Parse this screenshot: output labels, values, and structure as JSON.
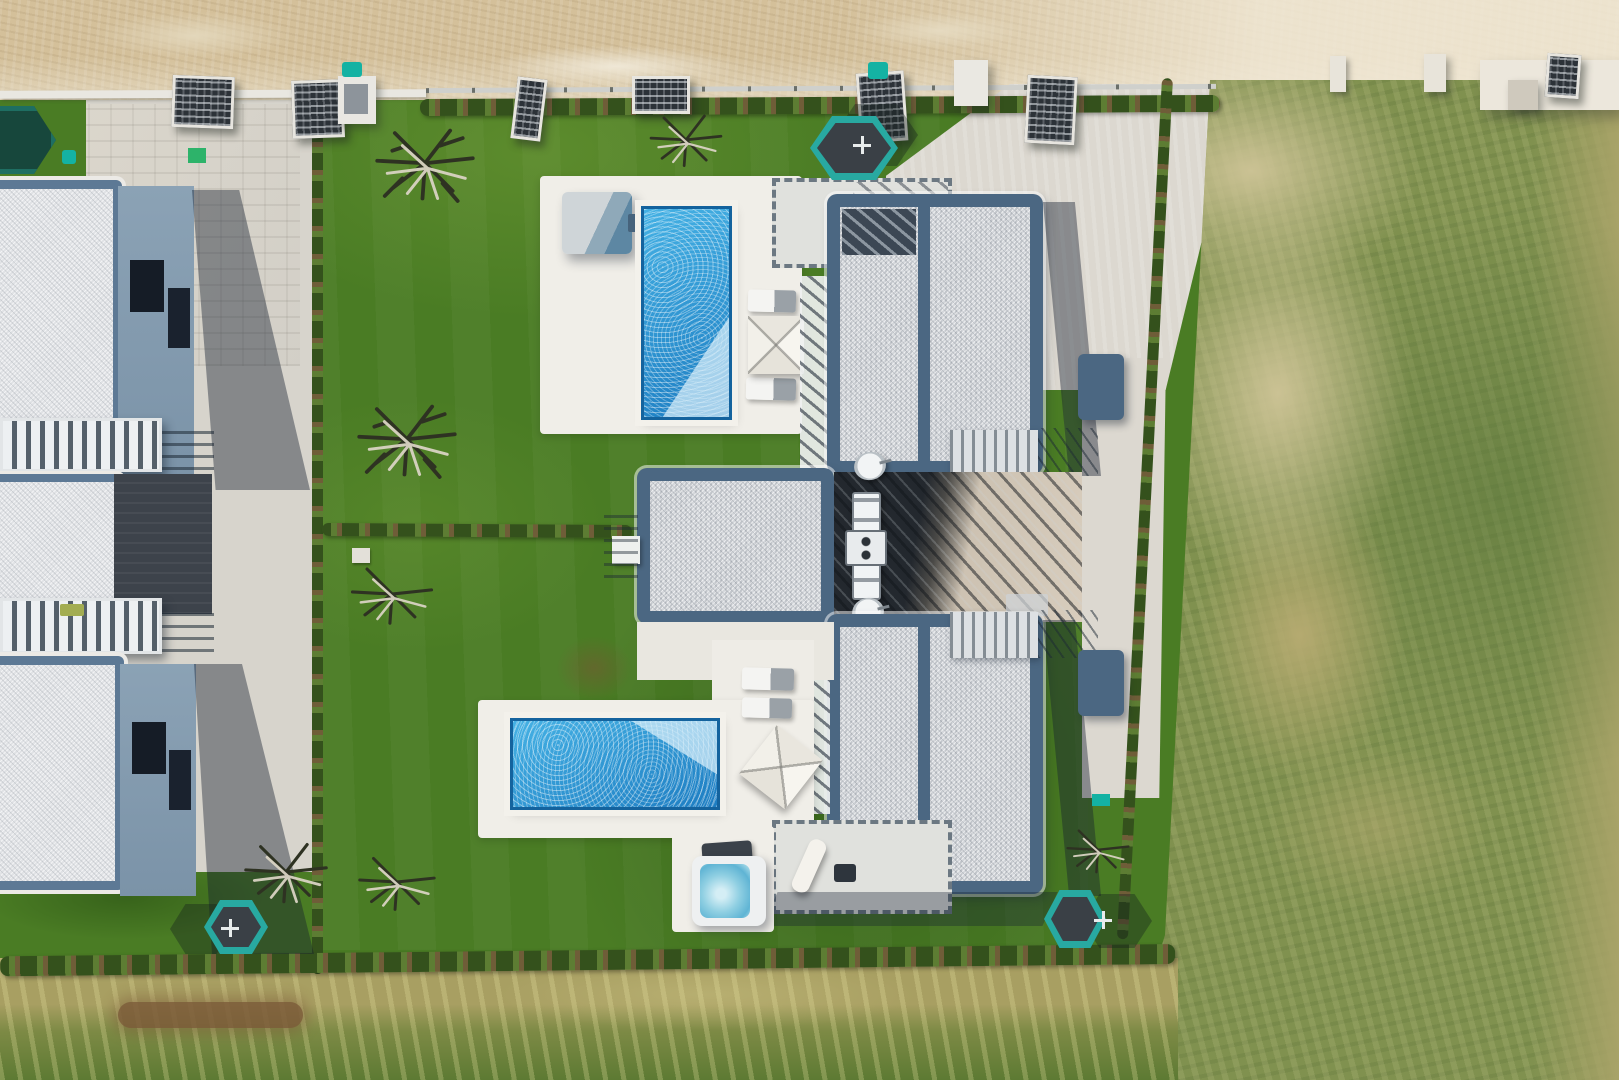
{
  "meta": {
    "title": "Aerial drone photograph, top-down view of a modern villa resort with private pools",
    "type": "aerial-photograph",
    "width_px": 1619,
    "height_px": 1080,
    "lighting": "bright midday sun, hard shadows cast toward the south-east"
  },
  "scene": {
    "setting": "Top-down drone view of a row of newly built modern holiday villas with white-gravel flat roofs framed in steel blue, bright green lawns, two rectangular swimming pools, a sandy dirt road along the top and a large patchy wild meadow on the right",
    "objects": [
      {
        "name": "dirt-road",
        "label": "Sandy gravel road running along the top edge"
      },
      {
        "name": "roadside-curb",
        "label": "Low white kerb wall between road and plots"
      },
      {
        "name": "roadside-hedge",
        "label": "Row of young hedge shrubs with wire fence along the road"
      },
      {
        "name": "entrance-gate",
        "label": "Dark slatted entrance gates and bin enclosures along the road",
        "count": 6
      },
      {
        "name": "wheelie-bin",
        "label": "Teal wheelie bins by the gates",
        "count": 2
      },
      {
        "name": "boundary-wall-ne",
        "label": "White boundary wall with dark gate, top-right corner"
      },
      {
        "name": "meadow",
        "label": "Large patchy olive-green wild meadow covering the right side"
      },
      {
        "name": "boundary-hedge",
        "label": "Young boundary hedges separating lawns, meadow and road",
        "count": 4
      },
      {
        "name": "left-villa",
        "label": "Neighbouring villas with white-gravel roofs, slatted balconies and blue-grey walls, partially visible at the left edge",
        "count": 2
      },
      {
        "name": "central-villa",
        "label": "Mirrored pair of modern villas with steel-blue roof frames joined by a flat central wing",
        "count": 2
      },
      {
        "name": "roof-skylight",
        "label": "Ribbed skylight strip with vent box on the central wing"
      },
      {
        "name": "satellite-dish",
        "label": "White satellite dishes at the roof edges",
        "count": 2
      },
      {
        "name": "pergola-deck",
        "label": "Dark timber deck with pergola slat shadows between the two villas"
      },
      {
        "name": "swimming-pool",
        "label": "Rectangular private pools with white stone surrounds and sun sparkle",
        "count": 2
      },
      {
        "name": "pool-shed",
        "label": "Grey pool equipment box beside the upper pool"
      },
      {
        "name": "sun-lounger",
        "label": "Grey and white sun loungers on the pool terraces",
        "count": 5
      },
      {
        "name": "parasol",
        "label": "Square white parasols, one folded on the lower terrace",
        "count": 3
      },
      {
        "name": "hot-tub",
        "label": "Square hot tub with aqua water and dark cover, lower garden"
      },
      {
        "name": "trampoline",
        "label": "Hexagonal trampolines with teal padding and safety nets",
        "count": 4
      },
      {
        "name": "dead-tree",
        "label": "Young bare olive trees with pale trunks lying on the lawns",
        "count": 7
      },
      {
        "name": "lawn",
        "label": "Bright green landscaped lawns around the villas"
      },
      {
        "name": "lawn-hedge-divider",
        "label": "Low hedge rows dividing the west lawns"
      },
      {
        "name": "driveway",
        "label": "Pale concrete driveway apron and side path inside the plot"
      },
      {
        "name": "paver-terrace",
        "label": "Paved terrace strip serving the left villas"
      },
      {
        "name": "stairs",
        "label": "External stairs with thin metal railings",
        "count": 4
      },
      {
        "name": "terrace-fence",
        "label": "Dashed-looking post fences around the ground terraces",
        "count": 2
      },
      {
        "name": "dirt-track",
        "label": "Worn brown track in the rough grass strip at the bottom"
      }
    ],
    "palette": {
      "road1": "#d4c09a",
      "road2": "#e3d7bb",
      "road3": "#efe7d5",
      "curb": "#e9e7e1",
      "fence": "#cfd0cc",
      "hedge1": "#34511c",
      "hedge2": "#5d7d33",
      "hedge3": "#6f5d38",
      "lawn": "#4a7c24",
      "lawnHi": "#5b902c",
      "lawnLo": "#38651c",
      "field1": "#80914f",
      "field2": "#b5aa70",
      "field3": "#cbc294",
      "field4": "#a8a368",
      "strip1": "#a89f62",
      "strip2": "#5d7a33",
      "dirt": "#7b5a38",
      "paving": "#dcd8d0",
      "patio": "#d7d4cc",
      "deck": "#f0eee8",
      "frame": "#4b6782",
      "frame2": "#5d7995",
      "gravel": "#d3d6da",
      "gravel2": "#e0e2e5",
      "wall": "#879fb3",
      "window": "#151c26",
      "shadow": "rgba(21,32,48,0.42)",
      "court": "#3d434b",
      "deckDark": "#23282e",
      "deckMid": "#5a636b",
      "deckLight": "#cdc2b2",
      "pool1": "#45b1e4",
      "pool2": "#1d7dc2",
      "poolRim": "#14639e",
      "poolPale": "#d8effa",
      "coping": "#f3f1eb",
      "teal": "#28a9a1",
      "teal2": "#14b2a3",
      "mat": "#3a4046",
      "white": "#eef0f1",
      "steel": "#5d87a3",
      "shed": "#cfd5d8",
      "stair": "#dde0e3",
      "lid": "#3b424a",
      "tub": "#8fcfe2",
      "tree1": "#2e3222",
      "tree2": "#d9d3c3",
      "sat": "#f2f4f5",
      "sky": "#f0f3f5",
      "greenPad": "#2db36a"
    }
  }
}
